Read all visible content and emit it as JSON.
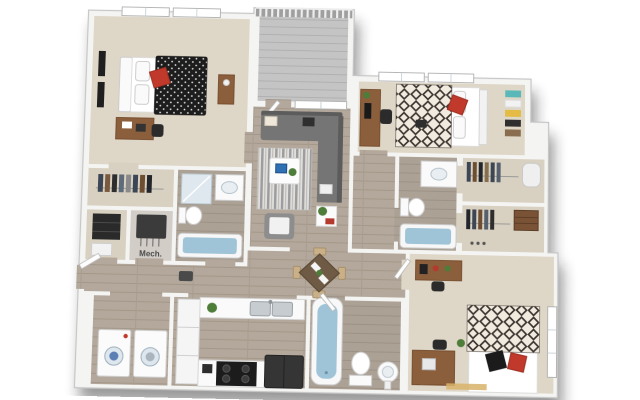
{
  "scene": {
    "type": "3d-floor-plan-render",
    "background": "#ffffff",
    "shadow_color": "#1f1f1f"
  },
  "labels": {
    "mech_room": "Mech."
  },
  "palette": {
    "wall": "#f4f4f3",
    "wall_edge": "#c6c6c6",
    "carpet": "#ded6c6",
    "wood_floor": "#b3a89b",
    "bath_floor": "#b6aca0",
    "balcony_deck": "#c4c4c4",
    "tub_water": "#9fc4d8",
    "accent_red": "#c0392b",
    "furniture_wood": "#8b5e3c",
    "sofa_gray": "#757575",
    "appliance_dark": "#1c1c1c",
    "shelf_teal": "#5bb8b8",
    "shelf_yellow": "#e3bb45"
  },
  "rooms": [
    {
      "name": "bedroom-1",
      "furniture": [
        "bed-black-duvet-red-pillow",
        "desk",
        "chair",
        "nightstand",
        "wall-art",
        "two-windows"
      ]
    },
    {
      "name": "balcony",
      "furniture": [
        "railing",
        "deck"
      ]
    },
    {
      "name": "living-room",
      "furniture": [
        "sectional-sofa",
        "striped-rug",
        "coffee-table",
        "laptop",
        "armchair",
        "side-table",
        "plant",
        "balcony-door",
        "window"
      ]
    },
    {
      "name": "bedroom-2",
      "furniture": [
        "bed-diamond-duvet-red-pillow",
        "desk-with-monitor",
        "chair",
        "ladder-shelf",
        "two-windows"
      ]
    },
    {
      "name": "walk-in-closet-left",
      "furniture": [
        "hanging-clothes"
      ]
    },
    {
      "name": "storage-nook",
      "furniture": [
        "shelving-unit",
        "white-bin"
      ]
    },
    {
      "name": "mech-room",
      "furniture": [
        "mechanical-unit"
      ]
    },
    {
      "name": "bathroom-1",
      "furniture": [
        "shower",
        "vanity-sink",
        "toilet",
        "tub"
      ]
    },
    {
      "name": "bathroom-2",
      "furniture": [
        "vanity-sink",
        "toilet",
        "tub"
      ]
    },
    {
      "name": "closet-a",
      "furniture": [
        "hanging-clothes",
        "water-heater"
      ]
    },
    {
      "name": "closet-b",
      "furniture": [
        "hanging-clothes",
        "dresser"
      ]
    },
    {
      "name": "hallway",
      "furniture": [
        "console"
      ]
    },
    {
      "name": "dining-area",
      "furniture": [
        "square-table",
        "four-chairs",
        "plant"
      ]
    },
    {
      "name": "kitchen",
      "furniture": [
        "double-sink-counter",
        "cabinet-column",
        "stove",
        "refrigerator",
        "plant"
      ]
    },
    {
      "name": "laundry-closet",
      "furniture": [
        "washer",
        "dryer"
      ]
    },
    {
      "name": "bathroom-3",
      "furniture": [
        "tub",
        "toilet",
        "pedestal-sink"
      ]
    },
    {
      "name": "bedroom-3",
      "furniture": [
        "bed-diamond-duvet-black-red-pillows",
        "desk",
        "chair",
        "dresser",
        "plant",
        "window"
      ]
    },
    {
      "name": "entry",
      "furniture": [
        "front-door"
      ]
    }
  ]
}
